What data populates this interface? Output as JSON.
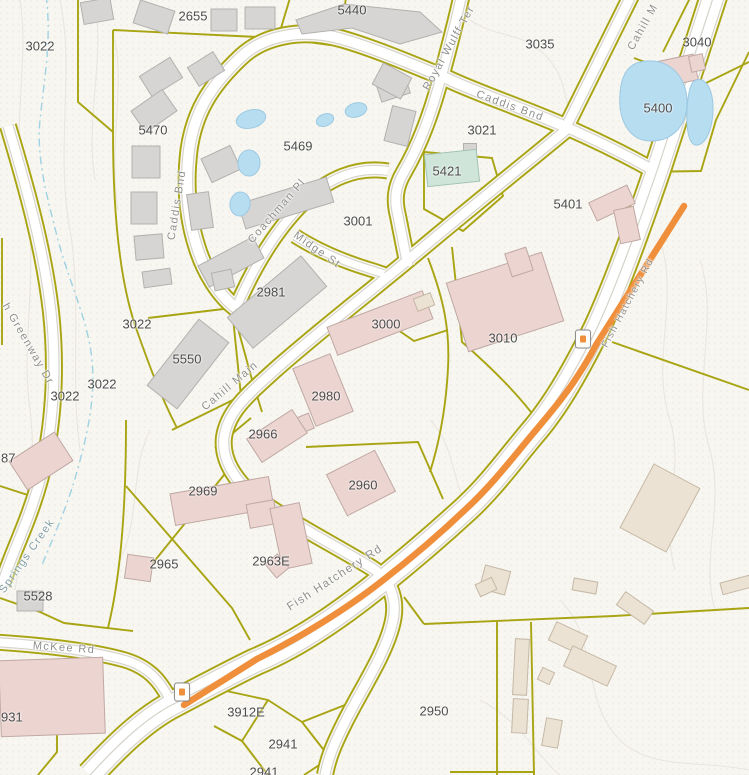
{
  "map": {
    "colors": {
      "background": "#f7f6f1",
      "parcel_line": "#a8a412",
      "road_fill": "#ffffff",
      "road_casing": "#d5d2ca",
      "highlight_orange": "#ef8f3c",
      "water": "#b7ddf1",
      "water_edge": "#9cc9e2",
      "creek": "#9fd2e2",
      "contour": "#e9e6dd",
      "stipple": "#ddd9cb",
      "building_gray": "#d6d5d3",
      "building_gray_edge": "#b2b1ae",
      "building_pink": "#ecd4d0",
      "building_pink_edge": "#c0a8a3",
      "building_tan": "#ece2d4",
      "building_tan_edge": "#c5b8a5",
      "building_teal": "#cfe5da",
      "building_teal_edge": "#a3c2b3",
      "parcel_label": "#4c4c4c",
      "street_label": "#8f8f8d"
    },
    "parcel_labels": [
      {
        "t": "3022",
        "x": 40,
        "y": 46
      },
      {
        "t": "2655",
        "x": 193,
        "y": 16
      },
      {
        "t": "5440",
        "x": 352,
        "y": 10
      },
      {
        "t": "3035",
        "x": 540,
        "y": 44
      },
      {
        "t": "3040",
        "x": 697,
        "y": 42
      },
      {
        "t": "5400",
        "x": 658,
        "y": 108
      },
      {
        "t": "5470",
        "x": 153,
        "y": 130
      },
      {
        "t": "5469",
        "x": 298,
        "y": 146
      },
      {
        "t": "3021",
        "x": 482,
        "y": 130
      },
      {
        "t": "5421",
        "x": 447,
        "y": 171
      },
      {
        "t": "5401",
        "x": 568,
        "y": 204
      },
      {
        "t": "3001",
        "x": 358,
        "y": 221
      },
      {
        "t": "2981",
        "x": 271,
        "y": 292
      },
      {
        "t": "3000",
        "x": 386,
        "y": 324
      },
      {
        "t": "3010",
        "x": 503,
        "y": 338
      },
      {
        "t": "3022",
        "x": 137,
        "y": 324
      },
      {
        "t": "3022",
        "x": 102,
        "y": 384
      },
      {
        "t": "3022",
        "x": 65,
        "y": 396
      },
      {
        "t": "5550",
        "x": 187,
        "y": 359
      },
      {
        "t": "2980",
        "x": 326,
        "y": 396
      },
      {
        "t": "2966",
        "x": 263,
        "y": 434
      },
      {
        "t": "2969",
        "x": 203,
        "y": 491
      },
      {
        "t": "2960",
        "x": 363,
        "y": 485
      },
      {
        "t": "2965",
        "x": 164,
        "y": 564
      },
      {
        "t": "2963E",
        "x": 271,
        "y": 561
      },
      {
        "t": "5528",
        "x": 38,
        "y": 596
      },
      {
        "t": "87",
        "x": 1,
        "y": 458,
        "a": "left"
      },
      {
        "t": "931",
        "x": 1,
        "y": 717,
        "a": "left"
      },
      {
        "t": "3912E",
        "x": 246,
        "y": 712
      },
      {
        "t": "2950",
        "x": 434,
        "y": 711
      },
      {
        "t": "2941",
        "x": 283,
        "y": 744
      },
      {
        "t": "2941",
        "x": 264,
        "y": 772
      }
    ],
    "street_labels": [
      {
        "t": "Royal Wulff Ter",
        "x": 449,
        "y": 48,
        "r": -61
      },
      {
        "t": "Caddis Bnd",
        "x": 510,
        "y": 106,
        "r": 20
      },
      {
        "t": "Caddis Bnd",
        "x": 177,
        "y": 205,
        "r": -81
      },
      {
        "t": "Coachman Pl",
        "x": 277,
        "y": 211,
        "r": -49
      },
      {
        "t": "Midge St",
        "x": 317,
        "y": 250,
        "r": 35
      },
      {
        "t": "Cahill Main",
        "x": 230,
        "y": 386,
        "r": -40
      },
      {
        "t": "Cahill M",
        "x": 643,
        "y": 27,
        "r": -61
      },
      {
        "t": "Fish Hatchery Rd",
        "x": 628,
        "y": 303,
        "r": -62,
        "s": 10
      },
      {
        "t": "Fish Hatchery Rd",
        "x": 335,
        "y": 578,
        "r": -33,
        "s": 11.5
      },
      {
        "t": "McKee Rd",
        "x": 64,
        "y": 648,
        "r": 4
      },
      {
        "t": "h Greenway Dr",
        "x": 28,
        "y": 344,
        "r": 60
      },
      {
        "t": "Springs Creek",
        "x": 27,
        "y": 556,
        "r": -55,
        "c": "creek"
      }
    ],
    "roads": [
      {
        "n": "greenway-dr",
        "w": 9,
        "d": "M8,126 C26,186 44,250 51,312 C57,368 54,428 40,480 C28,524 12,552 2,585"
      },
      {
        "n": "mckee-rd",
        "w": 8,
        "d": "M-5,642 C40,645 90,650 125,660 C148,667 160,680 170,700"
      },
      {
        "n": "caddis-bnd-loop",
        "w": 10,
        "d": "M566,127 C520,107 480,94 448,79 C402,60 370,47 342,39 C300,27 262,37 241,57 C209,87 194,114 189,150 C185,183 187,216 197,247 C205,273 220,296 236,308"
      },
      {
        "n": "coachman-pl",
        "w": 8,
        "d": "M236,308 C254,266 276,230 303,203 C327,179 356,166 388,171"
      },
      {
        "n": "midge-st",
        "w": 7,
        "d": "M295,236 C320,252 345,262 372,270 L384,274"
      },
      {
        "n": "royal-wulff-ter",
        "w": 9,
        "d": "M462,-6 C455,25 448,52 440,81 C430,118 418,148 404,172 C395,187 394,200 398,216 C402,236 405,252 408,266"
      },
      {
        "n": "cahill-main",
        "w": 9,
        "d": "M566,130 C520,168 470,208 420,250 C370,292 320,330 275,370 C245,397 228,412 224,437 C221,462 238,486 266,505 C300,528 340,548 372,568 C392,581 398,602 392,625 C384,656 362,688 345,722 C334,744 328,758 325,775"
      },
      {
        "n": "cahill-connector-north",
        "w": 9,
        "d": "M632,-6 L566,127"
      },
      {
        "n": "cahill-connector-east",
        "w": 9,
        "d": "M566,127 C600,142 632,158 658,173"
      },
      {
        "n": "fish-hatchery-rd",
        "w": 20,
        "d": "M715,-8 L658,168 C636,232 615,290 596,330 C577,368 557,404 534,431 C512,457 492,485 466,509 C441,532 412,557 381,582 C338,617 296,645 255,662 C228,675 200,690 168,707 C140,723 115,748 90,775"
      }
    ],
    "highlight": {
      "w": 6.5,
      "d": "M684,206 L596,345 C577,381 558,404 536,430 C514,456 493,484 467,508 C443,531 413,557 382,581 C348,608 301,637 257,659 L184,705"
    },
    "parcel_lines": [
      "M78,-2 L78,102 L113,132",
      "M113,30 L113,132",
      "M113,30 L278,38 L290,-2",
      "M278,38 L338,46 M338,46 L346,-2",
      "M113,132 C113,215 120,282 136,328 C148,362 160,395 177,428",
      "M2,238 L2,345",
      "M148,318 L232,308 L241,396 L172,430",
      "M234,314 L251,376 L262,412",
      "M424,152 L492,158 L503,196 L463,231 L424,209 Z",
      "M424,110 L424,152",
      "M428,258 C444,300 450,330 448,368 C446,408 440,440 430,472",
      "M448,330 L414,341 L372,312",
      "M452,247 L462,342 C492,368 520,396 540,424",
      "M306,447 L418,442 L443,499",
      "M126,486 L232,608 L250,640",
      "M228,470 L144,574",
      "M126,420 C126,500 122,570 108,628",
      "M215,448 L251,418",
      "M634,58 L704,84 L749,62",
      "M749,52 L716,120 L701,171 L640,172",
      "M690,-2 L663,52",
      "M612,342 L749,390",
      "M424,624 L614,616 L749,608",
      "M424,624 L404,597",
      "M497,622 L497,775",
      "M531,622 L534,775",
      "M208,687 L268,700 L302,722 L330,758 L304,775",
      "M302,722 L360,699",
      "M268,700 L242,741 L268,775",
      "M242,741 L214,726",
      "M0,664 L57,667 L57,752 L38,775",
      "M0,598 L40,612 L64,623 L133,631",
      "M0,486 L34,497 M34,497 L20,545",
      "M450,772 L535,772"
    ],
    "buildings": [
      {
        "k": "gray",
        "x": 97,
        "y": 11,
        "w": 30,
        "h": 22,
        "r": -10
      },
      {
        "k": "gray",
        "x": 154,
        "y": 17,
        "w": 36,
        "h": 24,
        "r": 18
      },
      {
        "k": "gray",
        "x": 224,
        "y": 20,
        "w": 26,
        "h": 22,
        "r": 0
      },
      {
        "k": "gray",
        "x": 260,
        "y": 18,
        "w": 30,
        "h": 22,
        "r": 0
      },
      {
        "k": "gray",
        "pts": "296,20 344,4 420,12 442,32 400,44 352,28 302,34"
      },
      {
        "k": "gray",
        "x": 393,
        "y": 88,
        "w": 30,
        "h": 20,
        "r": -18
      },
      {
        "k": "gray",
        "x": 161,
        "y": 77,
        "w": 36,
        "h": 24,
        "r": -32
      },
      {
        "k": "gray",
        "x": 206,
        "y": 69,
        "w": 30,
        "h": 22,
        "r": -32
      },
      {
        "k": "gray",
        "x": 154,
        "y": 111,
        "w": 38,
        "h": 26,
        "r": -35
      },
      {
        "k": "gray",
        "x": 146,
        "y": 162,
        "w": 28,
        "h": 32,
        "r": 0
      },
      {
        "k": "gray",
        "x": 144,
        "y": 208,
        "w": 26,
        "h": 32,
        "r": 0
      },
      {
        "k": "gray",
        "x": 149,
        "y": 247,
        "w": 28,
        "h": 24,
        "r": -5
      },
      {
        "k": "gray",
        "x": 221,
        "y": 164,
        "w": 32,
        "h": 26,
        "r": -25
      },
      {
        "k": "gray",
        "x": 200,
        "y": 211,
        "w": 22,
        "h": 36,
        "r": -8
      },
      {
        "k": "gray",
        "x": 286,
        "y": 203,
        "w": 92,
        "h": 26,
        "r": -17
      },
      {
        "k": "gray",
        "x": 231,
        "y": 262,
        "w": 62,
        "h": 24,
        "r": -28
      },
      {
        "k": "gray",
        "x": 392,
        "y": 81,
        "w": 32,
        "h": 24,
        "r": 28
      },
      {
        "k": "gray",
        "x": 400,
        "y": 126,
        "w": 24,
        "h": 36,
        "r": 14
      },
      {
        "k": "gray",
        "x": 277,
        "y": 302,
        "w": 96,
        "h": 40,
        "r": -40
      },
      {
        "k": "gray",
        "x": 223,
        "y": 280,
        "w": 20,
        "h": 18,
        "r": -12
      },
      {
        "k": "gray",
        "x": 157,
        "y": 278,
        "w": 28,
        "h": 16,
        "r": -8
      },
      {
        "k": "gray",
        "x": 188,
        "y": 364,
        "w": 84,
        "h": 38,
        "r": -52
      },
      {
        "k": "gray",
        "x": 30,
        "y": 601,
        "w": 26,
        "h": 20,
        "r": 0
      },
      {
        "k": "gray",
        "x": 470,
        "y": 149,
        "w": 13,
        "h": 11,
        "r": 0
      },
      {
        "k": "teal",
        "x": 452,
        "y": 168,
        "w": 52,
        "h": 32,
        "r": -6
      },
      {
        "k": "pink",
        "x": 676,
        "y": 71,
        "w": 40,
        "h": 26,
        "r": -12
      },
      {
        "k": "pink",
        "x": 697,
        "y": 63,
        "w": 14,
        "h": 16,
        "r": -12
      },
      {
        "k": "pink",
        "x": 612,
        "y": 203,
        "w": 42,
        "h": 20,
        "r": -25
      },
      {
        "k": "pink",
        "x": 627,
        "y": 225,
        "w": 20,
        "h": 34,
        "r": -12
      },
      {
        "k": "pink",
        "x": 380,
        "y": 323,
        "w": 102,
        "h": 30,
        "r": -21
      },
      {
        "k": "tan",
        "x": 424,
        "y": 302,
        "w": 18,
        "h": 13,
        "r": -21
      },
      {
        "k": "pink",
        "x": 505,
        "y": 302,
        "w": 100,
        "h": 72,
        "r": -18
      },
      {
        "k": "pink",
        "x": 519,
        "y": 262,
        "w": 22,
        "h": 24,
        "r": -18
      },
      {
        "k": "pink",
        "x": 323,
        "y": 390,
        "w": 40,
        "h": 62,
        "r": -22
      },
      {
        "k": "pink",
        "x": 303,
        "y": 424,
        "w": 18,
        "h": 16,
        "r": -22
      },
      {
        "k": "pink",
        "x": 277,
        "y": 436,
        "w": 54,
        "h": 28,
        "r": -33
      },
      {
        "k": "pink",
        "x": 222,
        "y": 501,
        "w": 100,
        "h": 32,
        "r": -10
      },
      {
        "k": "pink",
        "x": 262,
        "y": 514,
        "w": 28,
        "h": 24,
        "r": -10
      },
      {
        "k": "pink",
        "x": 361,
        "y": 483,
        "w": 54,
        "h": 46,
        "r": -27
      },
      {
        "k": "pink",
        "x": 291,
        "y": 536,
        "w": 30,
        "h": 62,
        "r": -12
      },
      {
        "k": "pink",
        "x": 277,
        "y": 566,
        "w": 16,
        "h": 18,
        "r": -40
      },
      {
        "k": "pink",
        "x": 139,
        "y": 568,
        "w": 26,
        "h": 24,
        "r": 8
      },
      {
        "k": "pink",
        "x": 41,
        "y": 461,
        "w": 54,
        "h": 34,
        "r": -33
      },
      {
        "k": "pink",
        "x": 52,
        "y": 697,
        "w": 104,
        "h": 76,
        "r": -2
      },
      {
        "k": "tan",
        "x": 660,
        "y": 508,
        "w": 52,
        "h": 72,
        "r": 28
      },
      {
        "k": "tan",
        "x": 495,
        "y": 580,
        "w": 26,
        "h": 24,
        "r": 15
      },
      {
        "k": "tan",
        "x": 486,
        "y": 587,
        "w": 18,
        "h": 13,
        "r": -25
      },
      {
        "k": "tan",
        "x": 585,
        "y": 586,
        "w": 24,
        "h": 12,
        "r": 10
      },
      {
        "k": "tan",
        "x": 736,
        "y": 585,
        "w": 30,
        "h": 12,
        "r": -15
      },
      {
        "k": "tan",
        "x": 635,
        "y": 608,
        "w": 34,
        "h": 16,
        "r": 35
      },
      {
        "k": "tan",
        "x": 568,
        "y": 638,
        "w": 34,
        "h": 20,
        "r": 25
      },
      {
        "k": "tan",
        "x": 590,
        "y": 666,
        "w": 48,
        "h": 22,
        "r": 25
      },
      {
        "k": "tan",
        "x": 546,
        "y": 676,
        "w": 13,
        "h": 13,
        "r": 25
      },
      {
        "k": "tan",
        "x": 521,
        "y": 667,
        "w": 14,
        "h": 56,
        "r": 3
      },
      {
        "k": "tan",
        "x": 520,
        "y": 716,
        "w": 15,
        "h": 34,
        "r": 3
      },
      {
        "k": "tan",
        "x": 552,
        "y": 733,
        "w": 16,
        "h": 28,
        "r": 10
      }
    ],
    "ponds": {
      "paths": [
        "M640,62 C666,56 686,74 687,100 C688,126 672,141 651,141 C629,141 618,120 620,94 C621,77 627,65 640,62 Z",
        "M696,80 C706,77 713,90 713,108 C713,129 706,143 698,145 C689,147 686,130 687,110 C688,94 690,82 696,80 Z"
      ],
      "ellipses": [
        [
          251,
          119,
          15,
          9,
          -15
        ],
        [
          249,
          163,
          11,
          13,
          0
        ],
        [
          240,
          204,
          10,
          12,
          10
        ],
        [
          325,
          120,
          9,
          6,
          -20
        ],
        [
          356,
          110,
          11,
          7,
          -15
        ]
      ]
    },
    "creek": "M46,-5 C52,40 44,80 40,120 C36,160 48,200 58,240 C70,285 88,320 92,360 C96,400 86,440 76,475 C66,510 52,540 42,565",
    "contours": [
      "M20,0 C30,60 10,130 25,200 C40,270 20,340 30,410 C38,470 25,530 15,590",
      "M60,0 C75,70 55,150 70,230 C82,300 70,380 80,450",
      "M95,0 C105,60 85,120 95,180",
      "M115,40 C125,90 108,150 118,210",
      "M150,430 C130,470 140,520 120,560",
      "M470,20 C500,40 520,30 545,55 C570,80 560,100 575,115",
      "M660,240 C680,300 650,360 670,420 C685,470 660,520 675,570",
      "M700,260 C720,320 690,390 710,450 C725,505 700,560 715,610",
      "M560,600 C600,640 580,700 620,740 C650,770 700,760 749,770",
      "M480,700 C520,720 540,760 560,775",
      "M430,420 C460,450 450,500 480,520"
    ],
    "markers": [
      {
        "x": 583,
        "y": 339
      },
      {
        "x": 182,
        "y": 692
      }
    ]
  }
}
